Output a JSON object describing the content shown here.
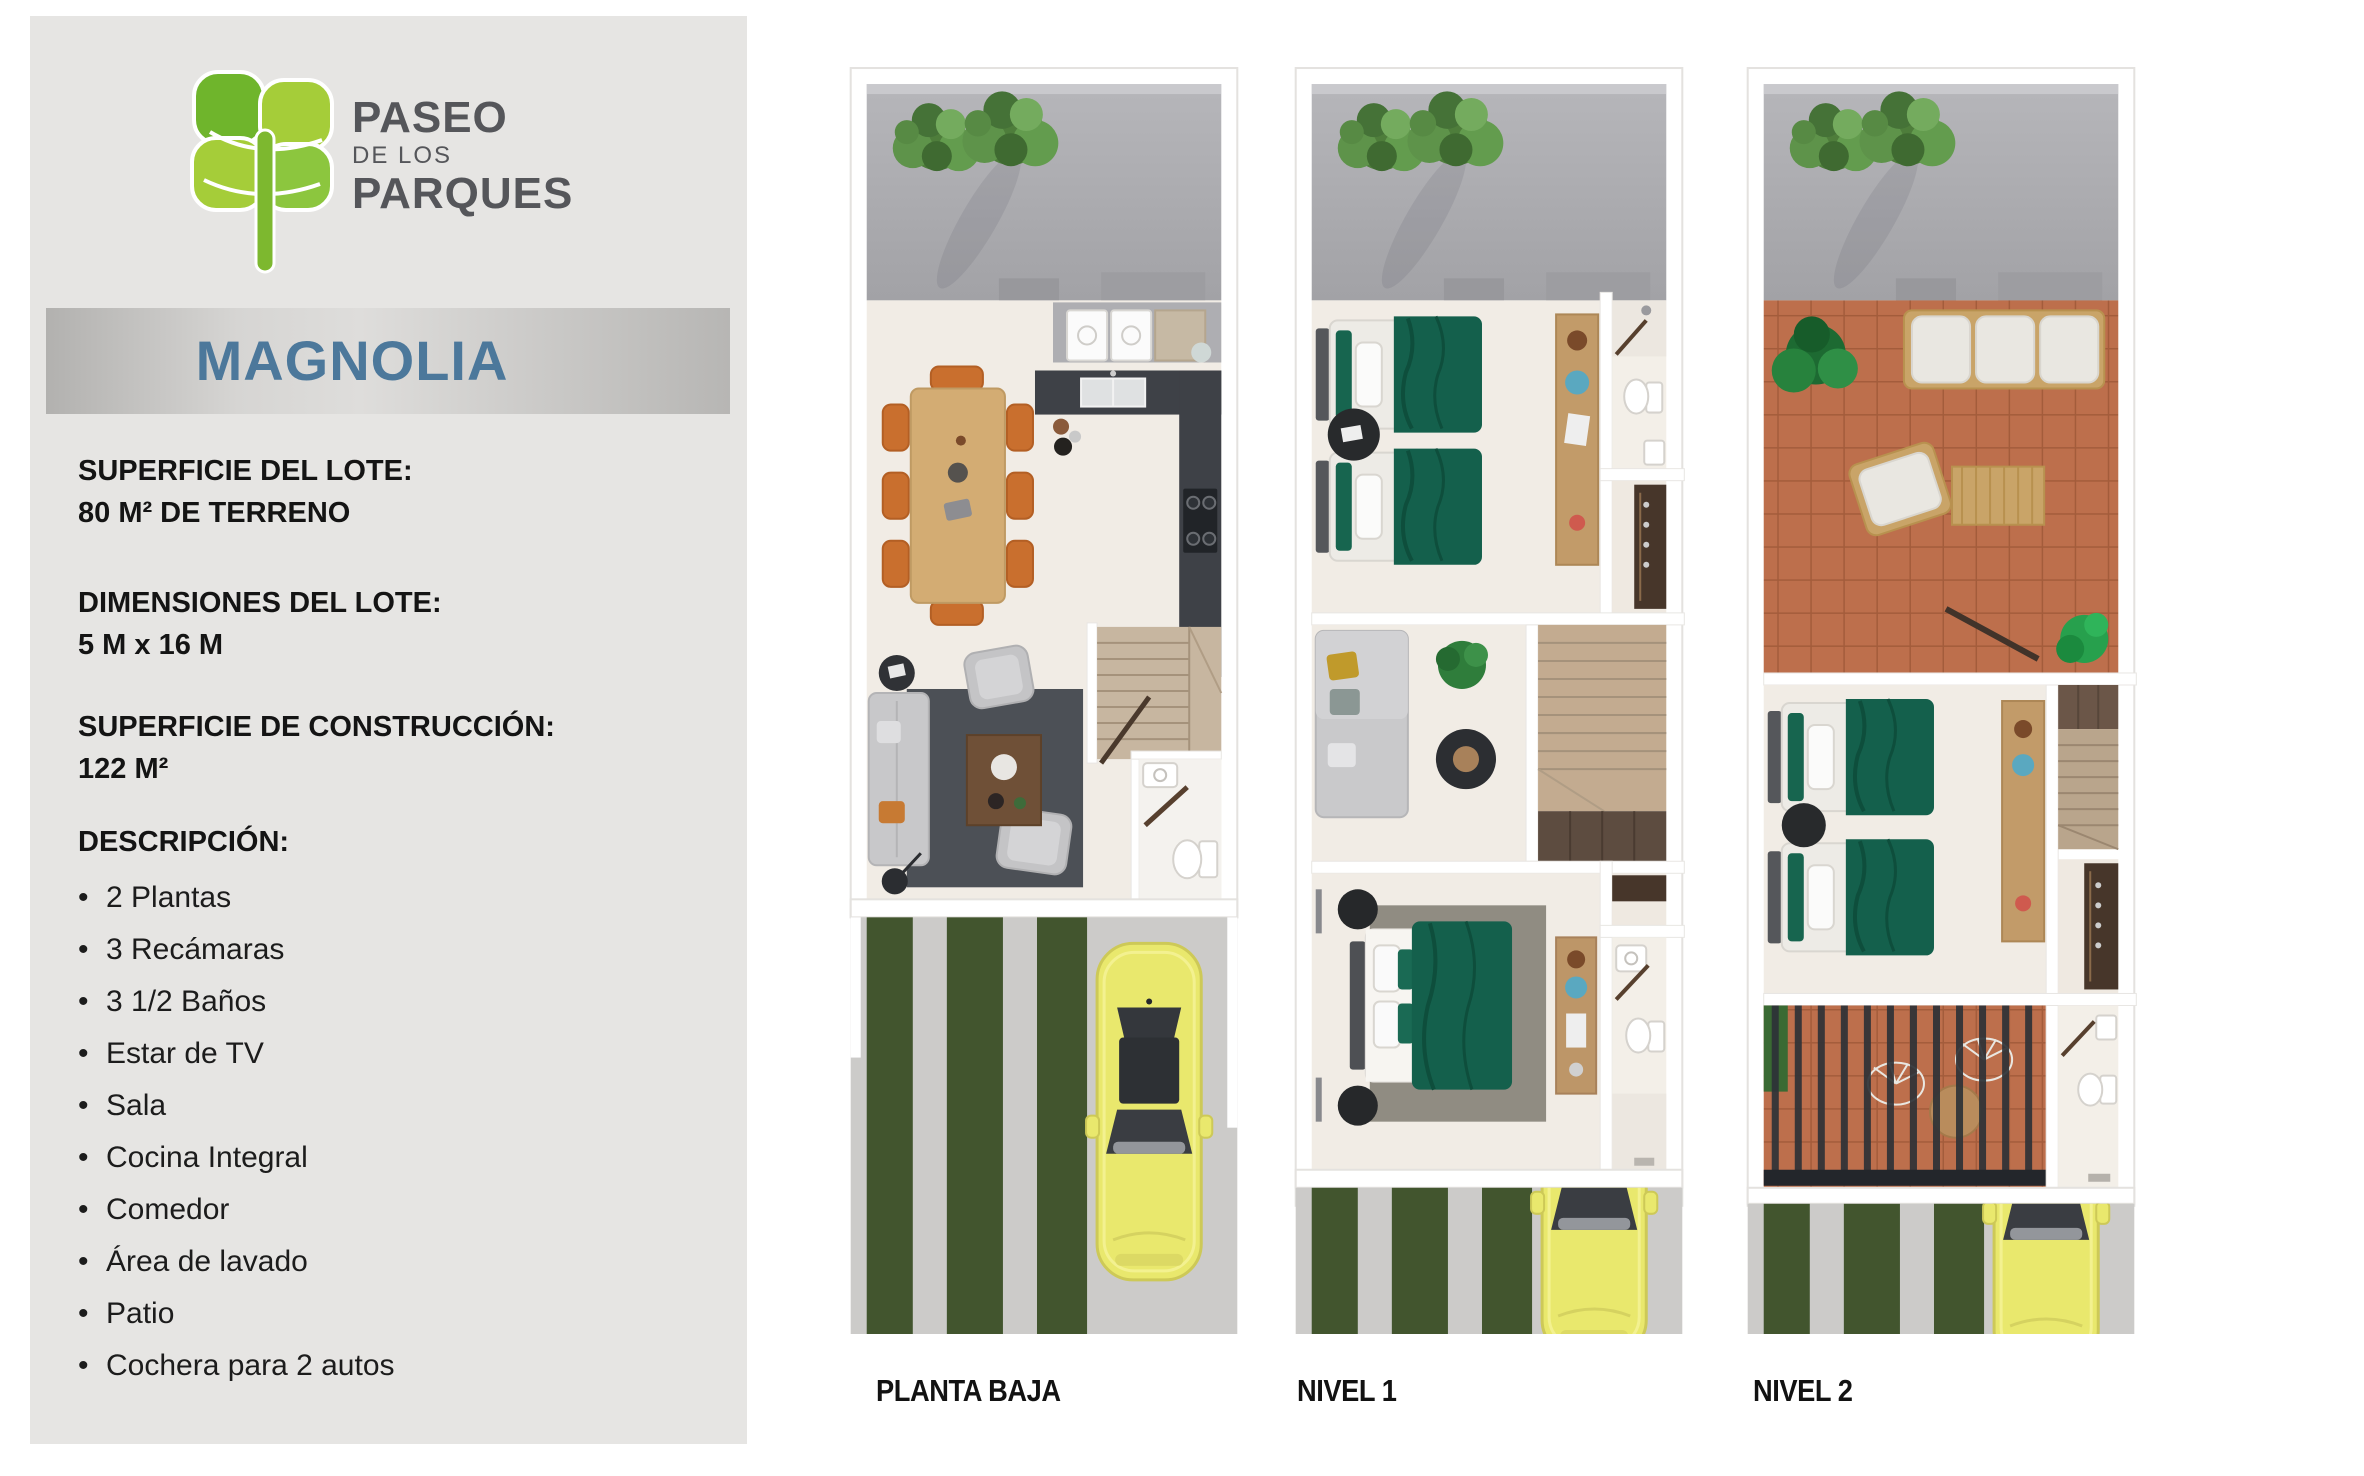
{
  "brand": {
    "name_line1": "PASEO",
    "name_line2": "DE LOS",
    "name_line3": "PARQUES"
  },
  "model_banner": {
    "name": "MAGNOLIA"
  },
  "specs": [
    {
      "title": "SUPERFICIE DEL LOTE:",
      "value": "80 M² DE TERRENO"
    },
    {
      "title": "DIMENSIONES DEL LOTE:",
      "value": "5 M x 16 M"
    },
    {
      "title": "SUPERFICIE DE CONSTRUCCIÓN:",
      "value": "122 M²"
    }
  ],
  "description": {
    "title": "DESCRIPCIÓN:",
    "items": [
      "2 Plantas",
      "3 Recámaras",
      "3 1/2 Baños",
      "Estar de TV",
      "Sala",
      "Cocina Integral",
      "Comedor",
      "Área de lavado",
      "Patio",
      "Cochera para 2 autos"
    ]
  },
  "floor_plans": [
    {
      "label": "PLANTA BAJA"
    },
    {
      "label": "NIVEL 1"
    },
    {
      "label": "NIVEL 2"
    }
  ],
  "colors": {
    "sidebar_bg": "#e6e5e3",
    "banner_silver": "#c9c8c6",
    "model_text_blue": "#4c789b",
    "logo_green_dark": "#6fb52c",
    "logo_green_light": "#a5cd39",
    "bed_green": "#14604c",
    "terrace_terracotta": "#bd6f4c",
    "patio_gray": "#a9a9ad",
    "grass_green": "#42552e",
    "car_yellow": "#e9e86d"
  }
}
